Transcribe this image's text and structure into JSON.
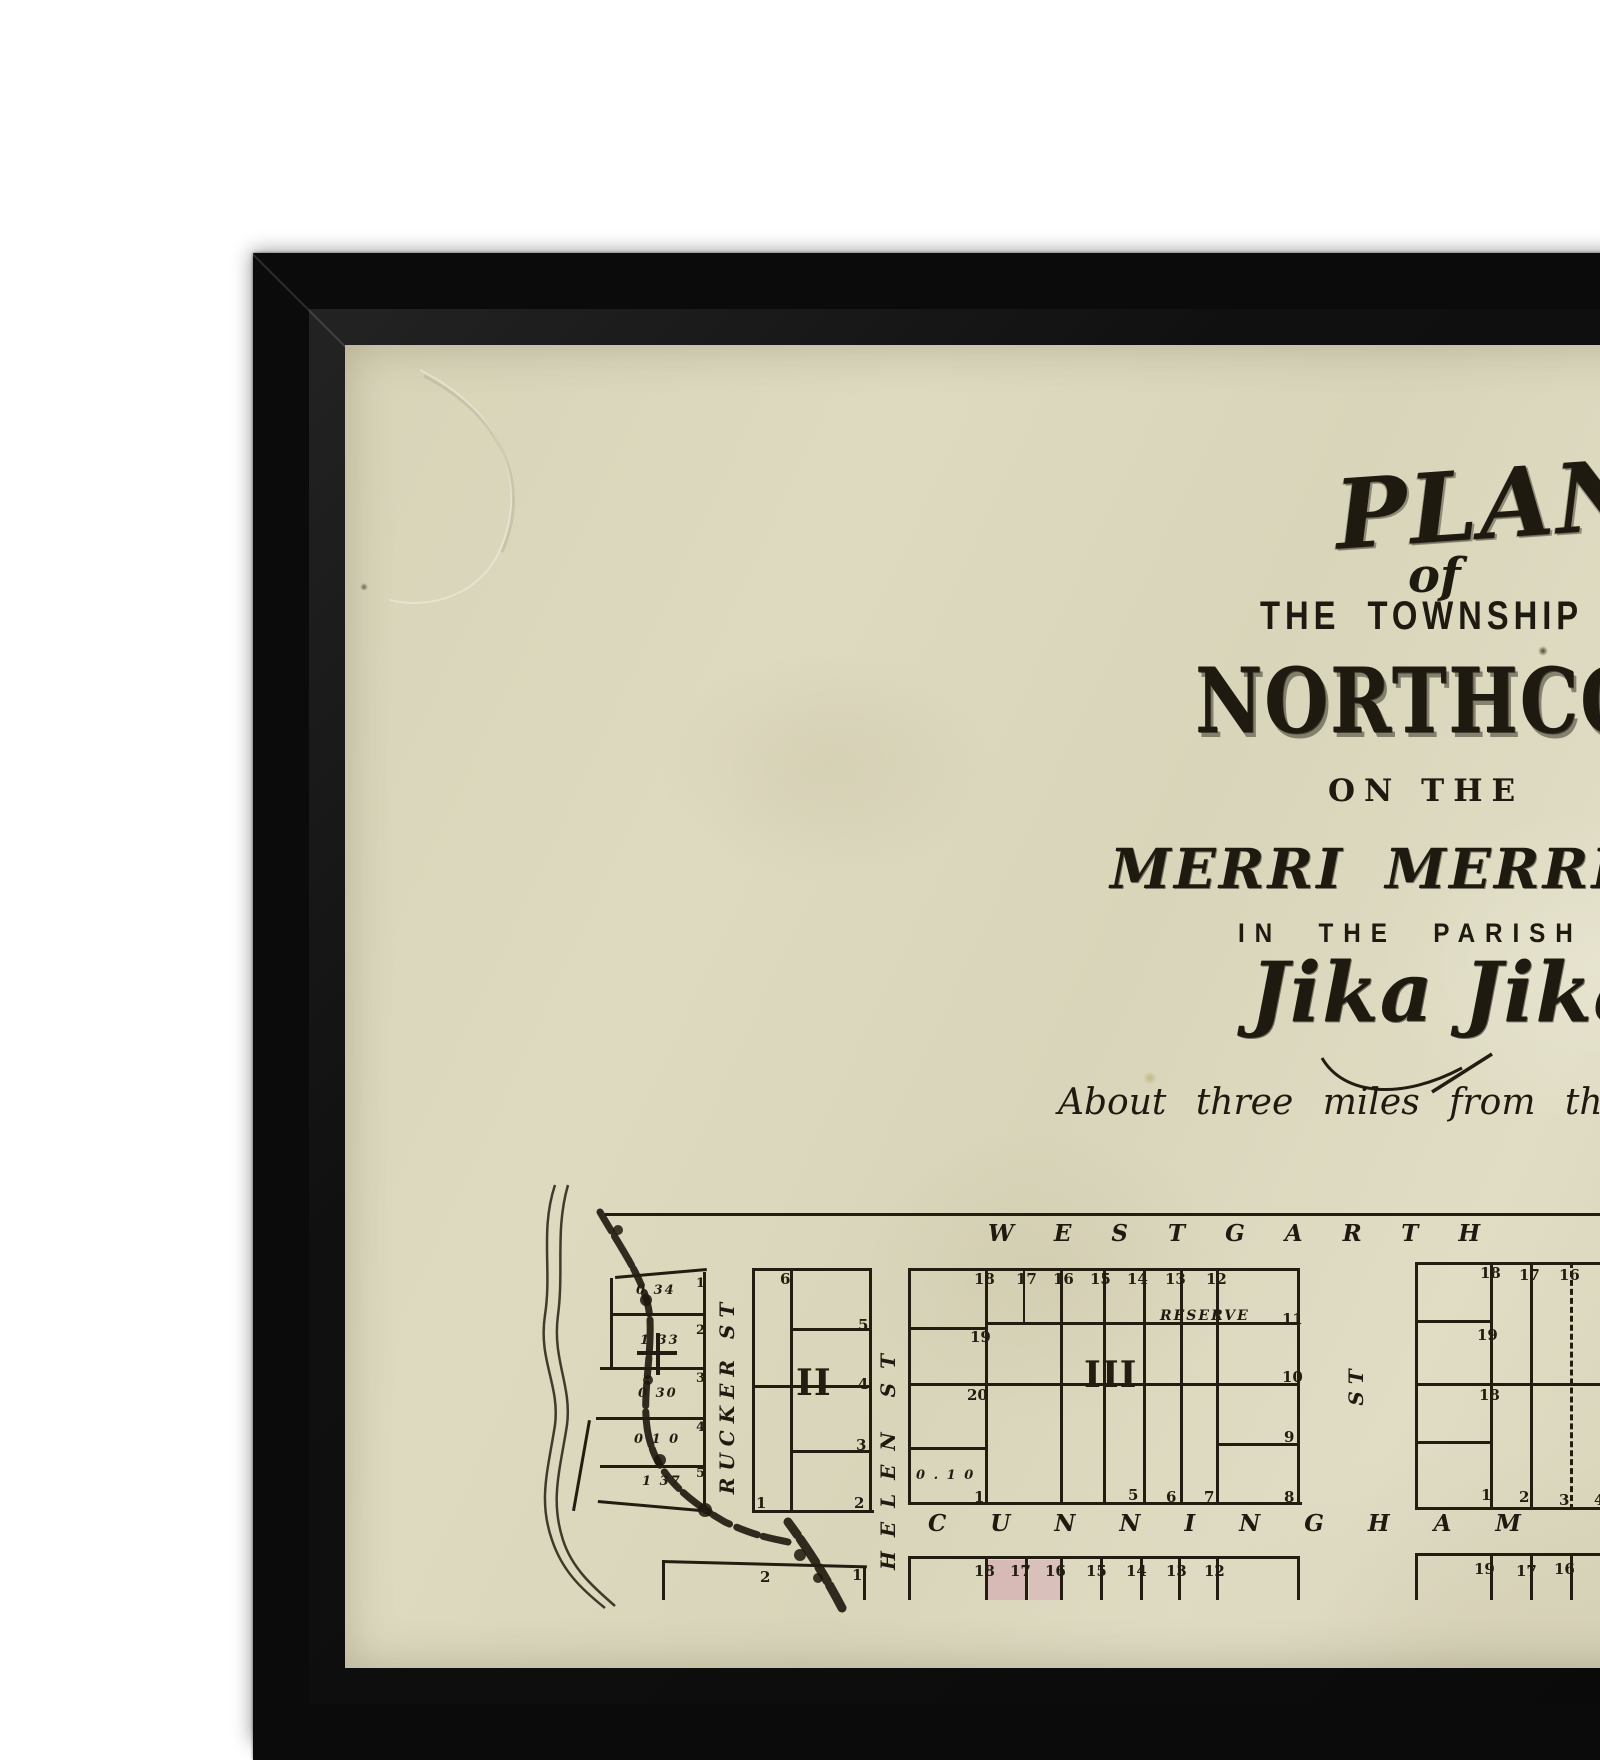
{
  "colors": {
    "frame": "#0b0b0b",
    "paper": "#dbd7bc",
    "ink": "#221d10",
    "lot_pink": "#d7bab6"
  },
  "title": {
    "plan": "PLAN",
    "of": "of",
    "township_line": "THE TOWNSHIP OF",
    "town_name": "NORTHCOTE",
    "on_the": "ON THE",
    "creek_line": "MERRI MERRI CREEK",
    "parish_line": "IN THE PARISH OF",
    "parish_name": "Jika Jika.",
    "subtitle": "About three miles from the City of Melbourne"
  },
  "map": {
    "streets": {
      "westgarth": "WESTGARTH",
      "cunningham": "CUNNINGHAM",
      "rucker": "RUCKER ST",
      "helen": "HELEN ST",
      "st_only": "ST",
      "reserve": "RESERVE"
    },
    "segments": [
      {
        "x": 605,
        "y": 1213,
        "w": 995,
        "h": 3
      },
      {
        "x": 703,
        "y": 1272,
        "w": 3,
        "h": 240
      },
      {
        "x": 615,
        "y": 1276,
        "w": 92,
        "h": 3,
        "r": -5
      },
      {
        "x": 610,
        "y": 1278,
        "w": 3,
        "h": 92
      },
      {
        "x": 612,
        "y": 1313,
        "w": 94,
        "h": 3
      },
      {
        "x": 600,
        "y": 1367,
        "w": 106,
        "h": 3
      },
      {
        "x": 596,
        "y": 1417,
        "w": 110,
        "h": 3
      },
      {
        "x": 600,
        "y": 1465,
        "w": 106,
        "h": 3
      },
      {
        "x": 588,
        "y": 1420,
        "w": 3,
        "h": 92,
        "r": 10
      },
      {
        "x": 598,
        "y": 1500,
        "w": 110,
        "h": 3,
        "r": 5
      },
      {
        "x": 656,
        "y": 1333,
        "w": 4,
        "h": 42
      },
      {
        "x": 637,
        "y": 1351,
        "w": 40,
        "h": 4
      },
      {
        "x": 752,
        "y": 1268,
        "w": 120,
        "h": 3
      },
      {
        "x": 752,
        "y": 1510,
        "w": 122,
        "h": 3
      },
      {
        "x": 752,
        "y": 1268,
        "w": 3,
        "h": 245
      },
      {
        "x": 869,
        "y": 1268,
        "w": 3,
        "h": 245
      },
      {
        "x": 790,
        "y": 1268,
        "w": 3,
        "h": 245
      },
      {
        "x": 752,
        "y": 1385,
        "w": 120,
        "h": 3
      },
      {
        "x": 790,
        "y": 1328,
        "w": 82,
        "h": 3
      },
      {
        "x": 790,
        "y": 1450,
        "w": 82,
        "h": 3
      },
      {
        "x": 908,
        "y": 1268,
        "w": 392,
        "h": 3
      },
      {
        "x": 908,
        "y": 1502,
        "w": 394,
        "h": 3
      },
      {
        "x": 908,
        "y": 1268,
        "w": 3,
        "h": 237
      },
      {
        "x": 1297,
        "y": 1268,
        "w": 3,
        "h": 237
      },
      {
        "x": 985,
        "y": 1268,
        "w": 3,
        "h": 237
      },
      {
        "x": 1060,
        "y": 1268,
        "w": 3,
        "h": 237
      },
      {
        "x": 1103,
        "y": 1268,
        "w": 3,
        "h": 237
      },
      {
        "x": 1143,
        "y": 1268,
        "w": 3,
        "h": 237
      },
      {
        "x": 1180,
        "y": 1268,
        "w": 3,
        "h": 237
      },
      {
        "x": 1216,
        "y": 1268,
        "w": 3,
        "h": 237
      },
      {
        "x": 1023,
        "y": 1268,
        "w": 2,
        "h": 56
      },
      {
        "x": 908,
        "y": 1327,
        "w": 80,
        "h": 3
      },
      {
        "x": 985,
        "y": 1322,
        "w": 315,
        "h": 3
      },
      {
        "x": 908,
        "y": 1383,
        "w": 392,
        "h": 3
      },
      {
        "x": 1216,
        "y": 1443,
        "w": 84,
        "h": 3
      },
      {
        "x": 908,
        "y": 1447,
        "w": 80,
        "h": 3
      },
      {
        "x": 1415,
        "y": 1262,
        "w": 185,
        "h": 3
      },
      {
        "x": 1415,
        "y": 1507,
        "w": 185,
        "h": 3
      },
      {
        "x": 1415,
        "y": 1262,
        "w": 3,
        "h": 248
      },
      {
        "x": 1490,
        "y": 1262,
        "w": 3,
        "h": 248
      },
      {
        "x": 1530,
        "y": 1262,
        "w": 3,
        "h": 248
      },
      {
        "x": 1570,
        "y": 1262,
        "w": 3,
        "h": 248,
        "dashed": true
      },
      {
        "x": 1415,
        "y": 1320,
        "w": 78,
        "h": 3
      },
      {
        "x": 1415,
        "y": 1383,
        "w": 185,
        "h": 3
      },
      {
        "x": 1415,
        "y": 1441,
        "w": 78,
        "h": 3
      },
      {
        "x": 908,
        "y": 1556,
        "w": 392,
        "h": 3
      },
      {
        "x": 908,
        "y": 1556,
        "w": 3,
        "h": 44
      },
      {
        "x": 985,
        "y": 1556,
        "w": 3,
        "h": 44
      },
      {
        "x": 1025,
        "y": 1556,
        "w": 3,
        "h": 44
      },
      {
        "x": 1060,
        "y": 1556,
        "w": 3,
        "h": 44
      },
      {
        "x": 1100,
        "y": 1556,
        "w": 3,
        "h": 44
      },
      {
        "x": 1140,
        "y": 1556,
        "w": 3,
        "h": 44
      },
      {
        "x": 1178,
        "y": 1556,
        "w": 3,
        "h": 44
      },
      {
        "x": 1216,
        "y": 1556,
        "w": 3,
        "h": 44
      },
      {
        "x": 1297,
        "y": 1556,
        "w": 3,
        "h": 44
      },
      {
        "x": 1415,
        "y": 1553,
        "w": 185,
        "h": 3
      },
      {
        "x": 1415,
        "y": 1553,
        "w": 3,
        "h": 47
      },
      {
        "x": 1490,
        "y": 1553,
        "w": 3,
        "h": 47
      },
      {
        "x": 1530,
        "y": 1553,
        "w": 3,
        "h": 47
      },
      {
        "x": 1570,
        "y": 1553,
        "w": 3,
        "h": 47
      },
      {
        "x": 662,
        "y": 1560,
        "w": 205,
        "h": 3,
        "r": 1.5
      },
      {
        "x": 863,
        "y": 1566,
        "w": 3,
        "h": 34
      },
      {
        "x": 662,
        "y": 1560,
        "w": 3,
        "h": 40
      }
    ],
    "fills": [
      {
        "x": 988,
        "y": 1560,
        "w": 38,
        "h": 40,
        "color": "#d7bab6"
      },
      {
        "x": 1029,
        "y": 1560,
        "w": 32,
        "h": 40,
        "color": "#d9c0ba"
      }
    ],
    "labels": [
      {
        "t": "0 34",
        "x": 636,
        "y": 1283,
        "c": "area"
      },
      {
        "t": "1 33",
        "x": 640,
        "y": 1333,
        "c": "area"
      },
      {
        "t": "0 30",
        "x": 638,
        "y": 1386,
        "c": "area"
      },
      {
        "t": "0 1 0",
        "x": 634,
        "y": 1432,
        "c": "area"
      },
      {
        "t": "1 37",
        "x": 642,
        "y": 1474,
        "c": "area"
      },
      {
        "t": "1",
        "x": 696,
        "y": 1276,
        "c": "lotsm"
      },
      {
        "t": "2",
        "x": 696,
        "y": 1323,
        "c": "lotsm"
      },
      {
        "t": "3",
        "x": 696,
        "y": 1371,
        "c": "lotsm"
      },
      {
        "t": "4",
        "x": 696,
        "y": 1420,
        "c": "lotsm"
      },
      {
        "t": "5",
        "x": 696,
        "y": 1466,
        "c": "lotsm"
      },
      {
        "t": "6",
        "x": 780,
        "y": 1270
      },
      {
        "t": "5",
        "x": 858,
        "y": 1316
      },
      {
        "t": "4",
        "x": 858,
        "y": 1375
      },
      {
        "t": "3",
        "x": 856,
        "y": 1436
      },
      {
        "t": "2",
        "x": 854,
        "y": 1494
      },
      {
        "t": "1",
        "x": 756,
        "y": 1494
      },
      {
        "t": "II",
        "x": 796,
        "y": 1362,
        "c": "roman"
      },
      {
        "t": "18",
        "x": 974,
        "y": 1270
      },
      {
        "t": "17",
        "x": 1016,
        "y": 1270
      },
      {
        "t": "16",
        "x": 1053,
        "y": 1270
      },
      {
        "t": "15",
        "x": 1090,
        "y": 1270
      },
      {
        "t": "14",
        "x": 1127,
        "y": 1270
      },
      {
        "t": "13",
        "x": 1165,
        "y": 1270
      },
      {
        "t": "12",
        "x": 1206,
        "y": 1270
      },
      {
        "t": "19",
        "x": 970,
        "y": 1328
      },
      {
        "t": "20",
        "x": 967,
        "y": 1386
      },
      {
        "t": "11",
        "x": 1282,
        "y": 1310
      },
      {
        "t": "10",
        "x": 1282,
        "y": 1368
      },
      {
        "t": "9",
        "x": 1284,
        "y": 1428
      },
      {
        "t": "8",
        "x": 1284,
        "y": 1488
      },
      {
        "t": "1",
        "x": 974,
        "y": 1488
      },
      {
        "t": "5",
        "x": 1128,
        "y": 1486
      },
      {
        "t": "6",
        "x": 1166,
        "y": 1488
      },
      {
        "t": "7",
        "x": 1204,
        "y": 1488
      },
      {
        "t": "0 . 1 0",
        "x": 916,
        "y": 1468,
        "c": "area"
      },
      {
        "t": "III",
        "x": 1084,
        "y": 1354,
        "c": "roman"
      },
      {
        "t": "18",
        "x": 1480,
        "y": 1264
      },
      {
        "t": "17",
        "x": 1519,
        "y": 1266
      },
      {
        "t": "16",
        "x": 1559,
        "y": 1266
      },
      {
        "t": "19",
        "x": 1477,
        "y": 1326
      },
      {
        "t": "18",
        "x": 1479,
        "y": 1386
      },
      {
        "t": "1",
        "x": 1481,
        "y": 1486
      },
      {
        "t": "2",
        "x": 1519,
        "y": 1488
      },
      {
        "t": "3",
        "x": 1559,
        "y": 1491
      },
      {
        "t": "4",
        "x": 1594,
        "y": 1491
      },
      {
        "t": "18",
        "x": 974,
        "y": 1562
      },
      {
        "t": "17",
        "x": 1010,
        "y": 1562
      },
      {
        "t": "16",
        "x": 1045,
        "y": 1562
      },
      {
        "t": "15",
        "x": 1086,
        "y": 1562
      },
      {
        "t": "14",
        "x": 1126,
        "y": 1562
      },
      {
        "t": "13",
        "x": 1166,
        "y": 1562
      },
      {
        "t": "12",
        "x": 1204,
        "y": 1562
      },
      {
        "t": "19",
        "x": 1474,
        "y": 1560
      },
      {
        "t": "17",
        "x": 1516,
        "y": 1562
      },
      {
        "t": "16",
        "x": 1554,
        "y": 1560
      },
      {
        "t": "2",
        "x": 760,
        "y": 1568
      },
      {
        "t": "1",
        "x": 852,
        "y": 1566
      }
    ]
  }
}
